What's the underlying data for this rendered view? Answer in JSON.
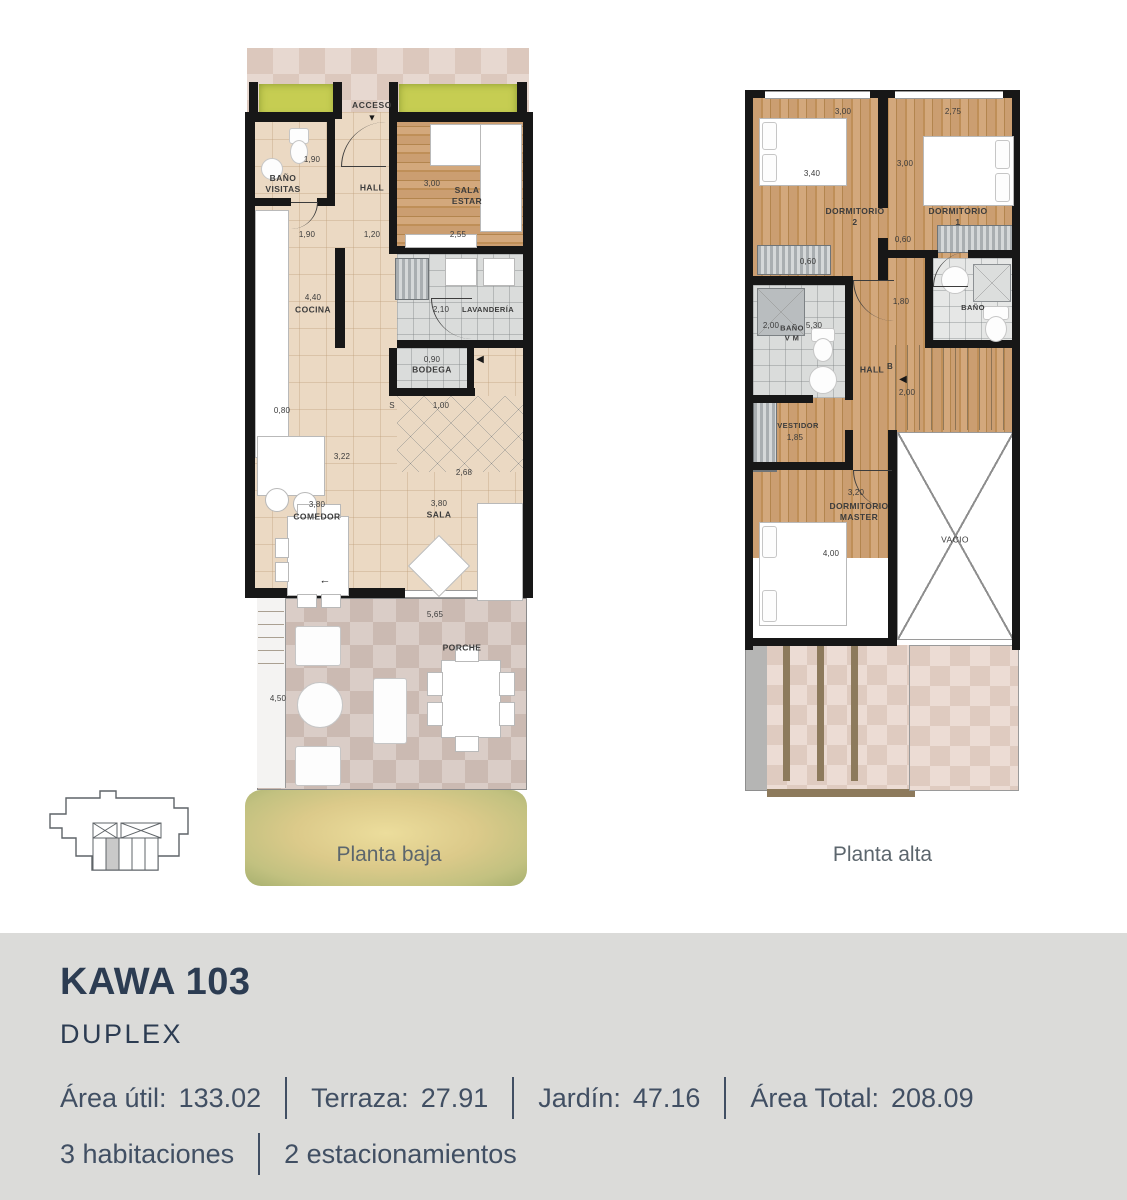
{
  "icons": {
    "access_arrow": "▼",
    "bodega_arrow": "◀",
    "door_arrow": "←",
    "stair_arrow": "◀"
  },
  "ground": {
    "caption": "Planta baja",
    "access_label": "ACCESO",
    "rooms": {
      "bano_visitas": {
        "label": "BAÑO\nVISITAS",
        "dim": "1,90"
      },
      "hall": {
        "label": "HALL"
      },
      "sala_estar": {
        "label": "SALA\nESTAR",
        "dim": "3,00"
      },
      "cocina": {
        "label": "COCINA",
        "dim": "4,40"
      },
      "lavanderia": {
        "label": "LAVANDERÍA",
        "dim": "2,10"
      },
      "bodega": {
        "label": "BODEGA",
        "dim": "0,90"
      },
      "comedor": {
        "label": "COMEDOR",
        "dim": "3,80"
      },
      "sala": {
        "label": "SALA",
        "dim": "3,80"
      },
      "porche": {
        "label": "PORCHE",
        "dim": "5,65"
      }
    },
    "dims": {
      "hall_left": "1,90",
      "hall_mid": "1,20",
      "sala_estar_bottom": "2,55",
      "kitchen_island": "0,80",
      "living_width": "3,22",
      "living_diag": "2,68",
      "stairs": "1,00",
      "stair_marker": "S",
      "side_patio": "4,50"
    }
  },
  "upper": {
    "caption": "Planta alta",
    "rooms": {
      "dormitorio_2": {
        "label": "DORMITORIO\n2",
        "width": "3,00",
        "depth": "3,40"
      },
      "dormitorio_1": {
        "label": "DORMITORIO\n1",
        "width": "2,75",
        "depth": "3,00"
      },
      "bano_vm": {
        "label": "BAÑO\nV M",
        "dim_a": "2,00",
        "dim_b": "5,30"
      },
      "bano": {
        "label": "BAÑO"
      },
      "hall": {
        "label": "HALL",
        "marker": "B"
      },
      "stairs": {
        "dim": "2,00"
      },
      "vestidor": {
        "label": "VESTIDOR",
        "dim": "1,85"
      },
      "dormitorio_master": {
        "label": "DORMITORIO\nMASTER",
        "width": "3,20",
        "depth": "4,00"
      },
      "vacio": {
        "label": "VACIO"
      }
    },
    "dims": {
      "closet_2": "0,60",
      "closet_1": "0,60",
      "pass": "1,80"
    }
  },
  "footer": {
    "title": "KAWA 103",
    "subtitle": "DUPLEX",
    "stats": [
      {
        "label": "Área útil:",
        "value": "133.02"
      },
      {
        "label": "Terraza:",
        "value": "27.91"
      },
      {
        "label": "Jardín:",
        "value": "47.16"
      },
      {
        "label": "Área Total:",
        "value": "208.09"
      }
    ],
    "features": [
      {
        "value": "3 habitaciones"
      },
      {
        "value": "2 estacionamientos"
      }
    ]
  }
}
